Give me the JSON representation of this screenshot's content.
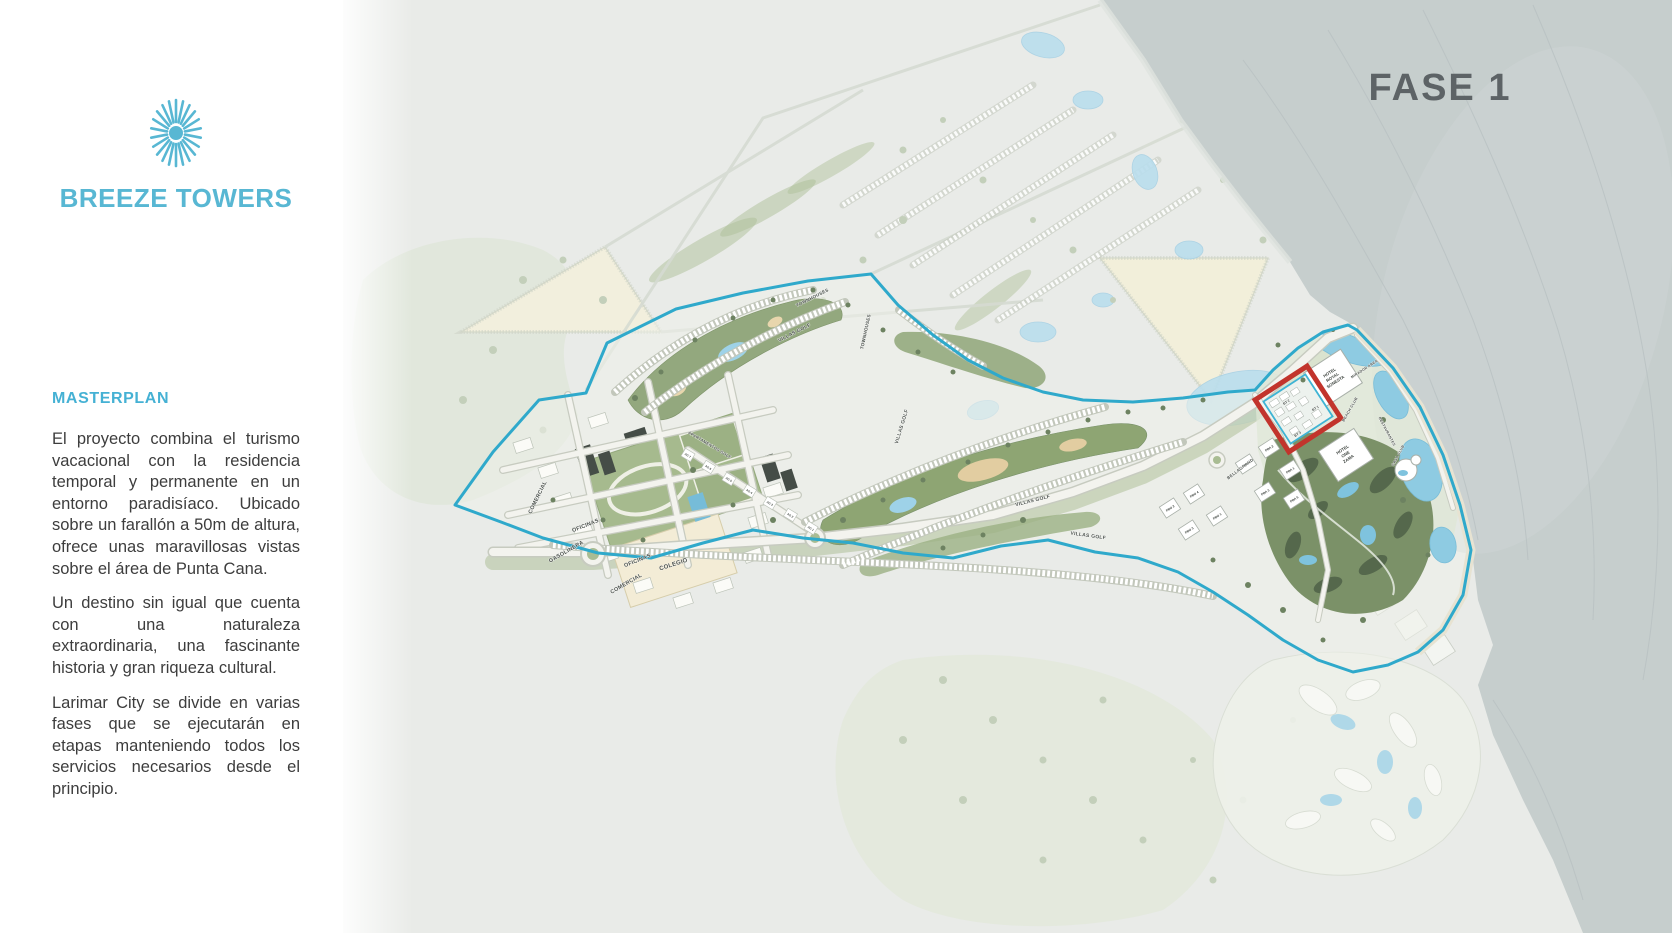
{
  "sidebar": {
    "brand": "BREEZE TOWERS",
    "heading": "MASTERPLAN",
    "paragraphs": {
      "p1": "El proyecto combina el turismo vacacional con la residencia temporal y permanente en un entorno paradisíaco. Ubicado sobre un farallón a 50m de altura, ofrece unas maravillosas vistas sobre el área de Punta Cana.",
      "p2": "Un destino sin igual que cuenta con una naturaleza extraordinaria, una fascinante historia y gran riqueza cultural.",
      "p3": "Larimar City se divide en varias fases que se ejecutarán en etapas manteniendo todos los servicios necesarios desde el principio."
    }
  },
  "map": {
    "phase_label": "FASE 1",
    "districts": {
      "comercial": "COMERCIAL",
      "oficinas": "OFICINAS",
      "gasolinera": "GASOLINERA",
      "colegio": "COLEGIO"
    },
    "roads": {
      "bellagrand": "BELLAGRAND",
      "villas_golf": "VILLAS GOLF",
      "townhouses": "TOWNHOUSES",
      "apartamentos_golf": "APARTAMENTOS GOLF",
      "restaurantes": "RESTAURANTES",
      "mirador_area": "MIRADOR AREA"
    },
    "hotels": {
      "royal_sonesta_l1": "HOTEL",
      "royal_sonesta_l2": "ROYAL",
      "royal_sonesta_l3": "SONESTA",
      "one_zama_l1": "HOTEL",
      "one_zama_l2": "ONE",
      "one_zama_l3": "ZAMA",
      "beach_club": "BEACH CLUB",
      "casa_club": "CASA CLUB"
    },
    "blocks": {
      "bt": [
        "BT 1",
        "BT 2",
        "BT 3"
      ],
      "pba": [
        "PBA 1",
        "PBA 2",
        "PBA 3",
        "PBA 4",
        "PBA 5"
      ],
      "pbo": [
        "PBO 1",
        "PBO 2",
        "PBO 3",
        "PBO 4"
      ],
      "ag": [
        "AG 1",
        "AG 2",
        "AG 3",
        "AG 4",
        "AG 5",
        "AG 6",
        "AG 7"
      ]
    },
    "highlight": {
      "color": "#c2342c",
      "boundary_color": "#2fa9cb"
    },
    "colors": {
      "brand_teal": "#58b7d3",
      "phase_text": "#5d6366",
      "water": "#8ecbe2",
      "cliff_gray": "#c6cecd"
    }
  }
}
